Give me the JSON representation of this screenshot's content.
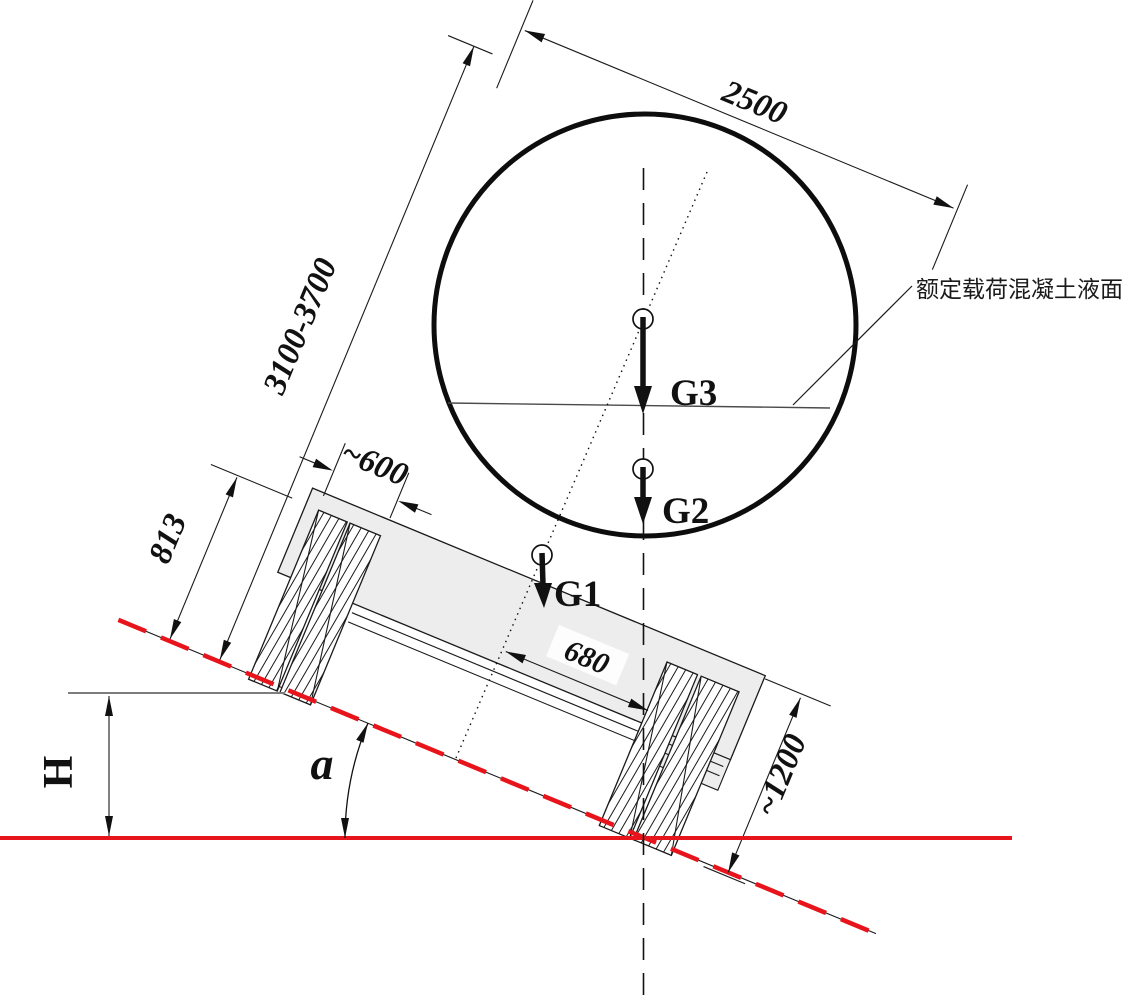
{
  "diagram": {
    "note_liquid_surface": "额定载荷混凝土液面",
    "dims": {
      "diameter": "2500",
      "height_range": "3100-3700",
      "support_width": "~600",
      "support_height": "813",
      "offset": "680",
      "rear_height": "~1200"
    },
    "forces": {
      "g1": "G1",
      "g2": "G2",
      "g3": "G3"
    },
    "angle_label": "a",
    "height_label": "H",
    "colors": {
      "red": "#e8141c",
      "body_gray": "#ededed",
      "line_black": "#1a1a1a",
      "ref_gray": "#7d7d7d",
      "liquid_gray": "#4a4a4a"
    }
  }
}
